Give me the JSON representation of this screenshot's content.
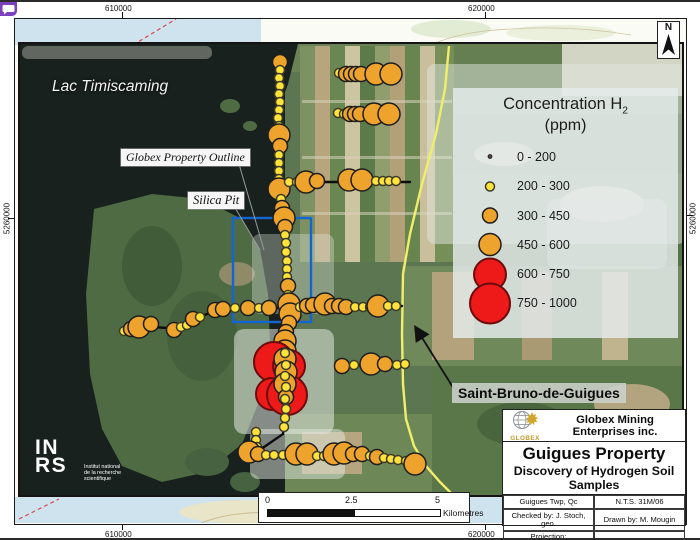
{
  "overlay_icon": {
    "name": "chat-bubble"
  },
  "map_frame": {
    "coords": {
      "top": [
        "610000",
        "620000"
      ],
      "bottom": [
        "610000",
        "620000"
      ],
      "left": "5260000",
      "right": "5260000"
    }
  },
  "labels": {
    "lake": "Lac Timiscaming",
    "property_outline": "Globex Property Outline",
    "silica_pit": "Silica Pit",
    "town": "Saint-Bruno-de-Guigues"
  },
  "north_arrow": {
    "label": "N"
  },
  "legend": {
    "title_main": "Concentration H",
    "title_sub": "2",
    "title_unit": "(ppm)",
    "classes": [
      {
        "label": "0 - 200",
        "r": 2,
        "fill": "#4a4038",
        "stroke": "#26211c"
      },
      {
        "label": "200 - 300",
        "r": 4.5,
        "fill": "#ffe23a",
        "stroke": "#3c3c28"
      },
      {
        "label": "300 - 450",
        "r": 7.5,
        "fill": "#eda32c",
        "stroke": "#1e1e1e"
      },
      {
        "label": "450 - 600",
        "r": 11,
        "fill": "#eda32c",
        "stroke": "#1e1e1e"
      },
      {
        "label": "600 - 750",
        "r": 16,
        "fill": "#ee1a1a",
        "stroke": "#6d0b0b"
      },
      {
        "label": "750 - 1000",
        "r": 20,
        "fill": "#ee1a1a",
        "stroke": "#6d0b0b"
      }
    ]
  },
  "scale_bar": {
    "ticks": [
      "0",
      "2.5",
      "5"
    ],
    "unit": "Kilometres"
  },
  "title_block": {
    "logo_text": "GLOBEX",
    "company": "Globex Mining Enterprises inc.",
    "title": "Guigues Property",
    "subtitle": "Discovery of Hydrogen Soil Samples",
    "cells": {
      "township": "Guigues Twp, Qc",
      "nts": "N.T.S. 31M/06",
      "checked": "Checked by: J. Stoch, geo.",
      "drawn": "Drawn by: M. Mougin",
      "projection_line1": "Projection:",
      "projection_line2": "UTM NAD83 Zone 17",
      "date": "Date: 2024-09-05"
    }
  },
  "inrs": {
    "line1": "IN",
    "line2": "RS",
    "tagline1": "Institut national",
    "tagline2": "de la recherche",
    "tagline3": "scientifique"
  },
  "map_data": {
    "note": "Hydrogen soil sample points; class = index into legend.classes",
    "road_color": "#f0ee6a",
    "property_rect_color": "#1464d2",
    "transects": [
      "278,57 278,150 277,185 281,214 284,250 286,300 288,312 284,330 283,412 281,430 262,443 249,448",
      "278,178 408,178",
      "336,70 392,70",
      "335,110 390,110",
      "120,328 138,322 165,324 190,316 215,306 240,304 290,304 400,302",
      "335,362 406,360",
      "245,449 300,450 340,449 370,452 416,461",
      "254,424 255,445"
    ],
    "samples": [
      [
        278,
        58,
        2
      ],
      [
        278,
        66,
        1
      ],
      [
        277,
        74,
        1
      ],
      [
        278,
        82,
        1
      ],
      [
        277,
        90,
        1
      ],
      [
        278,
        98,
        1
      ],
      [
        277,
        106,
        1
      ],
      [
        276,
        114,
        1
      ],
      [
        277,
        122,
        1
      ],
      [
        277,
        131,
        3
      ],
      [
        278,
        142,
        2
      ],
      [
        277,
        151,
        1
      ],
      [
        277,
        159,
        1
      ],
      [
        277,
        167,
        1
      ],
      [
        277,
        175,
        1
      ],
      [
        277,
        185,
        3
      ],
      [
        279,
        195,
        1
      ],
      [
        280,
        204,
        2
      ],
      [
        282,
        214,
        3
      ],
      [
        283,
        223,
        2
      ],
      [
        283,
        231,
        1
      ],
      [
        284,
        239,
        1
      ],
      [
        284,
        248,
        1
      ],
      [
        285,
        257,
        1
      ],
      [
        285,
        265,
        1
      ],
      [
        285,
        273,
        1
      ],
      [
        286,
        282,
        2
      ],
      [
        286,
        291,
        1
      ],
      [
        287,
        300,
        3
      ],
      [
        288,
        310,
        3
      ],
      [
        287,
        319,
        2
      ],
      [
        284,
        328,
        2
      ],
      [
        283,
        337,
        3
      ],
      [
        283,
        347,
        3
      ],
      [
        272,
        358,
        5
      ],
      [
        287,
        362,
        4
      ],
      [
        270,
        390,
        4
      ],
      [
        285,
        391,
        5
      ],
      [
        283,
        355,
        3
      ],
      [
        284,
        368,
        3
      ],
      [
        283,
        380,
        3
      ],
      [
        284,
        393,
        2
      ],
      [
        283,
        349,
        1
      ],
      [
        284,
        361,
        1
      ],
      [
        283,
        372,
        1
      ],
      [
        284,
        383,
        1
      ],
      [
        283,
        395,
        1
      ],
      [
        284,
        405,
        1
      ],
      [
        283,
        414,
        1
      ],
      [
        282,
        423,
        1
      ],
      [
        254,
        428,
        1
      ],
      [
        254,
        436,
        1
      ],
      [
        255,
        443,
        1
      ],
      [
        337,
        69,
        1
      ],
      [
        344,
        70,
        2
      ],
      [
        349,
        70,
        2
      ],
      [
        354,
        70,
        2
      ],
      [
        359,
        70,
        2
      ],
      [
        374,
        70,
        3
      ],
      [
        389,
        70,
        3
      ],
      [
        336,
        109,
        1
      ],
      [
        342,
        110,
        1
      ],
      [
        348,
        110,
        2
      ],
      [
        353,
        110,
        2
      ],
      [
        358,
        110,
        2
      ],
      [
        372,
        110,
        3
      ],
      [
        387,
        110,
        3
      ],
      [
        287,
        178,
        1
      ],
      [
        295,
        178,
        1
      ],
      [
        304,
        178,
        3
      ],
      [
        315,
        177,
        2
      ],
      [
        347,
        176,
        3
      ],
      [
        360,
        176,
        3
      ],
      [
        374,
        177,
        1
      ],
      [
        381,
        177,
        1
      ],
      [
        387,
        177,
        1
      ],
      [
        394,
        177,
        1
      ],
      [
        122,
        327,
        1
      ],
      [
        129,
        325,
        2
      ],
      [
        137,
        323,
        3
      ],
      [
        149,
        320,
        2
      ],
      [
        172,
        326,
        2
      ],
      [
        179,
        323,
        1
      ],
      [
        185,
        321,
        1
      ],
      [
        191,
        315,
        2
      ],
      [
        198,
        313,
        1
      ],
      [
        213,
        306,
        2
      ],
      [
        221,
        305,
        2
      ],
      [
        233,
        304,
        1
      ],
      [
        246,
        304,
        2
      ],
      [
        257,
        304,
        1
      ],
      [
        267,
        304,
        2
      ],
      [
        298,
        303,
        1
      ],
      [
        305,
        302,
        2
      ],
      [
        311,
        301,
        2
      ],
      [
        317,
        300,
        1
      ],
      [
        323,
        300,
        3
      ],
      [
        330,
        302,
        2
      ],
      [
        337,
        302,
        2
      ],
      [
        344,
        303,
        2
      ],
      [
        353,
        303,
        1
      ],
      [
        361,
        303,
        1
      ],
      [
        368,
        303,
        1
      ],
      [
        376,
        302,
        3
      ],
      [
        386,
        302,
        1
      ],
      [
        394,
        302,
        1
      ],
      [
        340,
        362,
        2
      ],
      [
        352,
        361,
        1
      ],
      [
        369,
        360,
        3
      ],
      [
        383,
        360,
        2
      ],
      [
        395,
        361,
        1
      ],
      [
        403,
        360,
        1
      ],
      [
        247,
        448,
        3
      ],
      [
        256,
        450,
        2
      ],
      [
        264,
        451,
        1
      ],
      [
        272,
        451,
        1
      ],
      [
        281,
        451,
        1
      ],
      [
        294,
        450,
        3
      ],
      [
        305,
        450,
        3
      ],
      [
        315,
        452,
        1
      ],
      [
        322,
        452,
        1
      ],
      [
        332,
        450,
        3
      ],
      [
        342,
        449,
        3
      ],
      [
        351,
        450,
        2
      ],
      [
        360,
        450,
        2
      ],
      [
        368,
        452,
        1
      ],
      [
        375,
        453,
        2
      ],
      [
        382,
        454,
        1
      ],
      [
        389,
        455,
        1
      ],
      [
        396,
        456,
        1
      ],
      [
        404,
        457,
        1
      ],
      [
        413,
        460,
        3
      ]
    ]
  }
}
